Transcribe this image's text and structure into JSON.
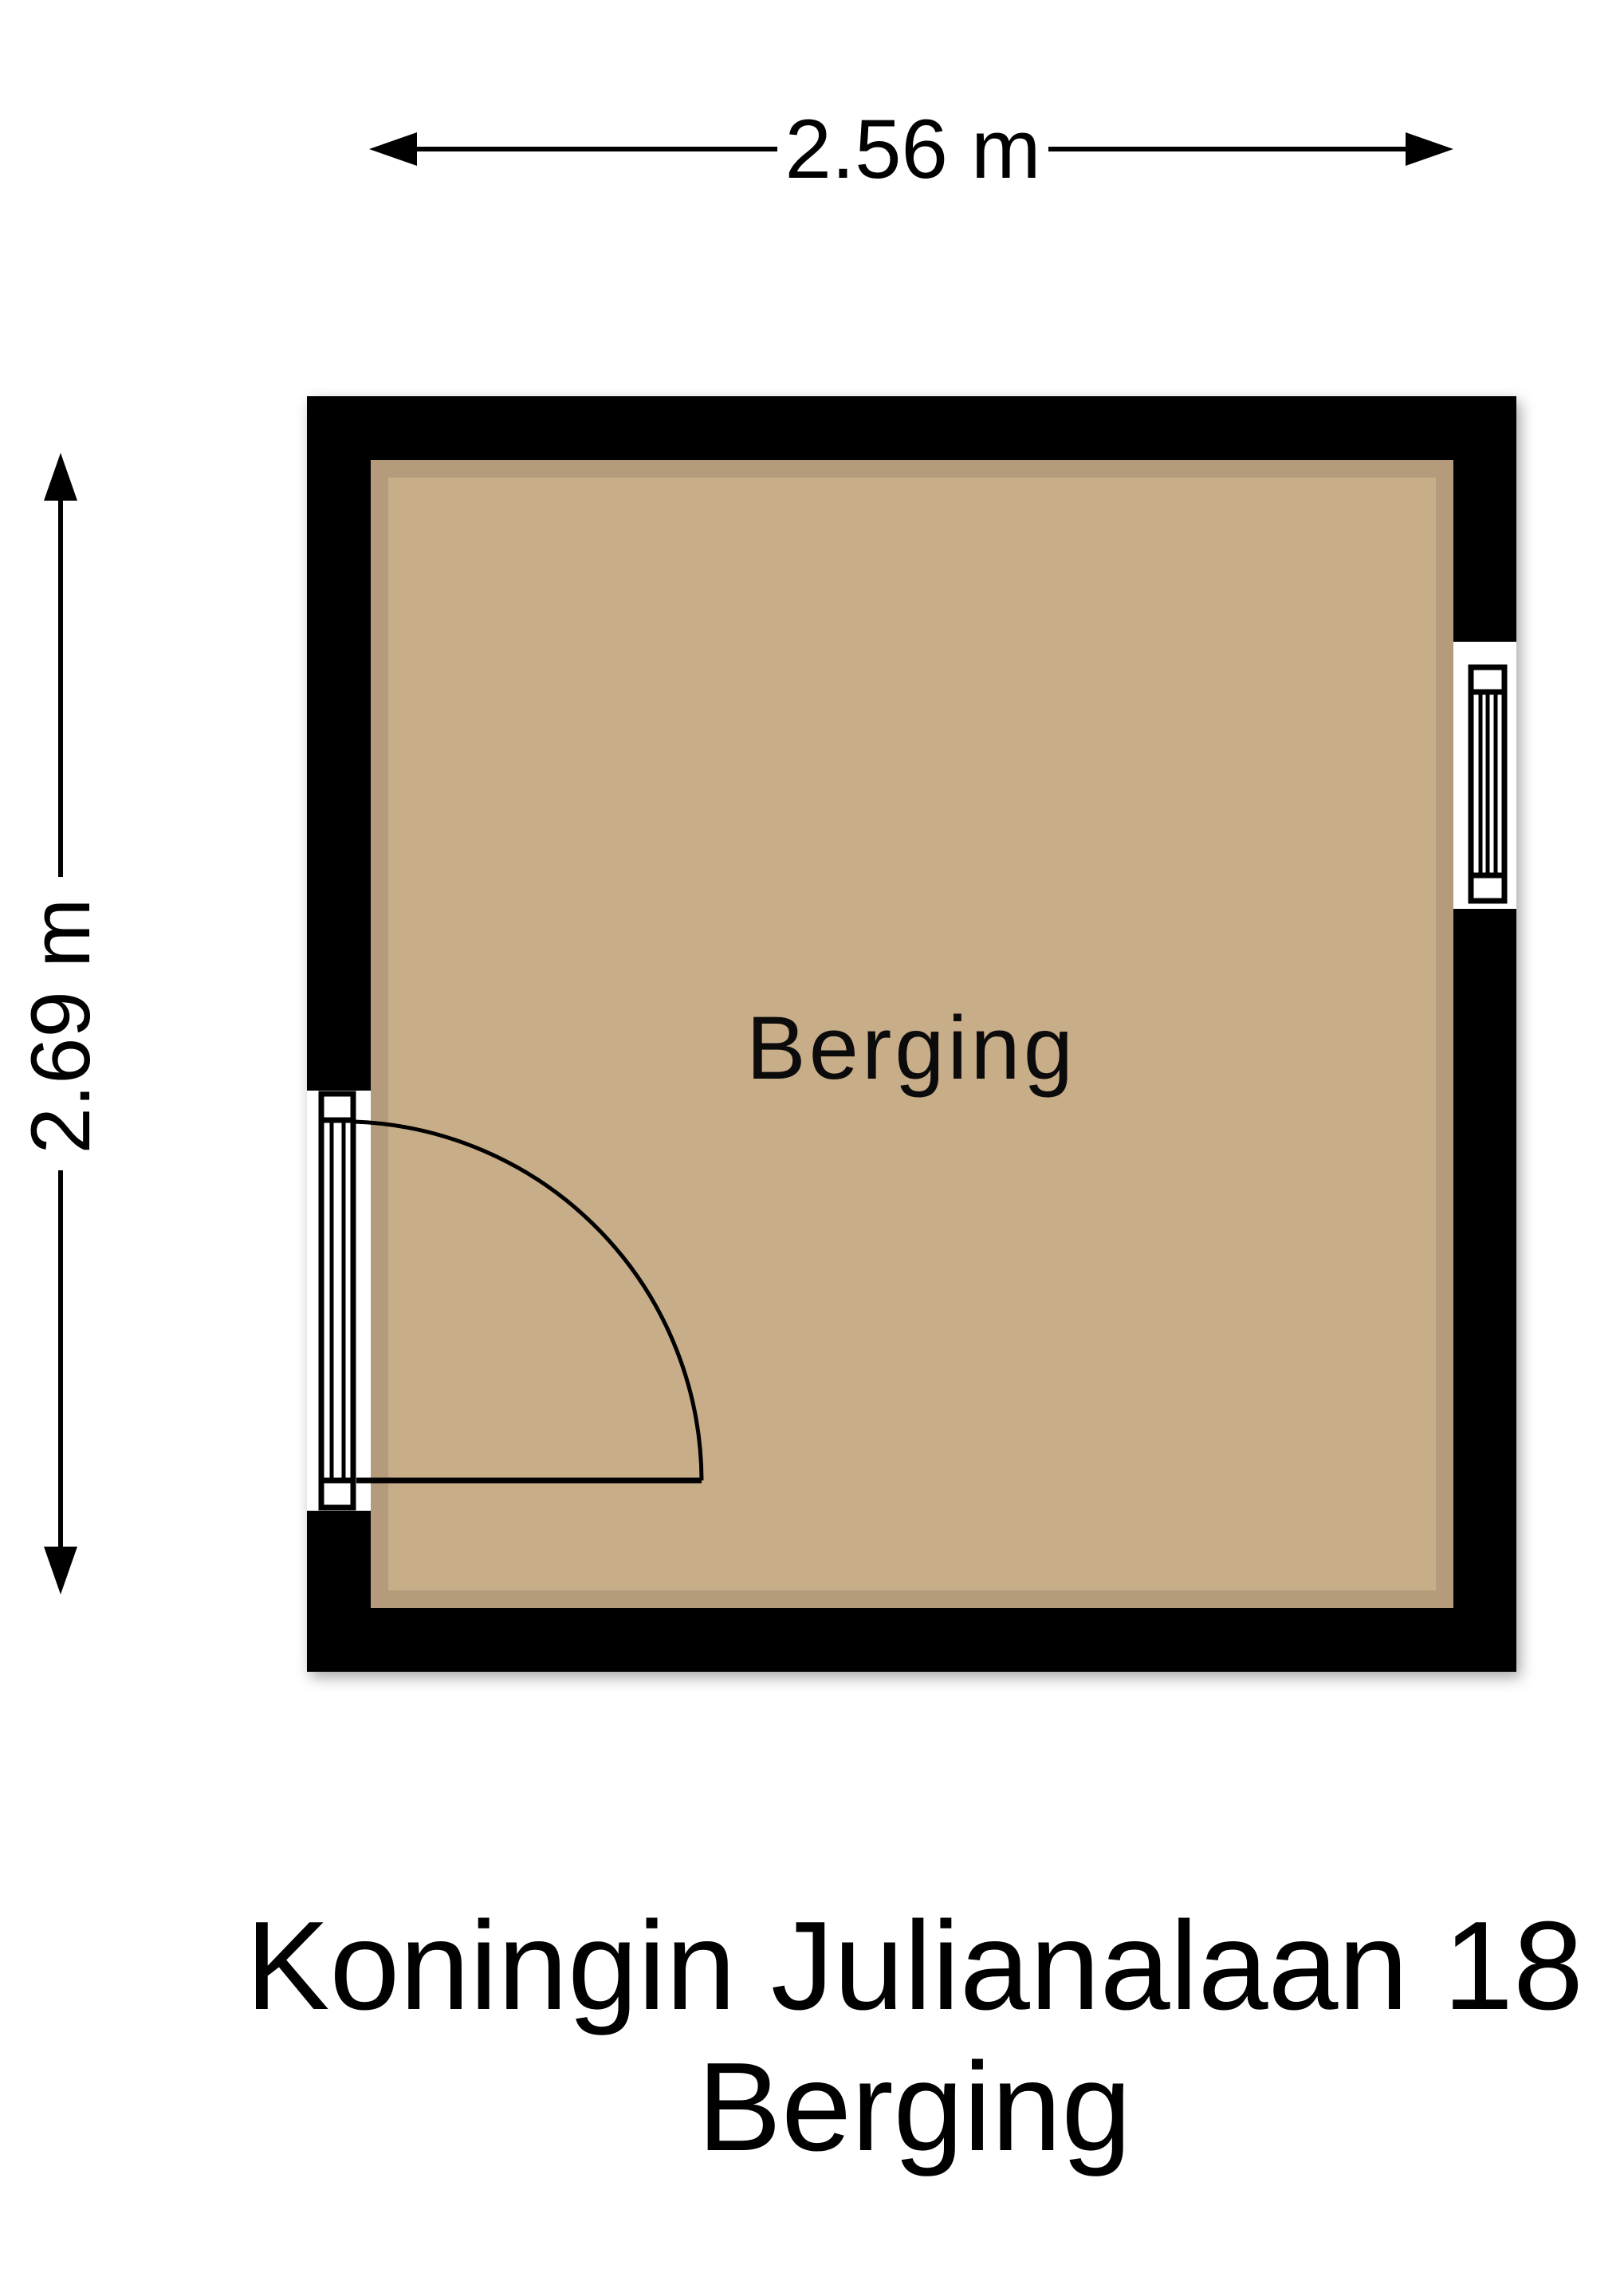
{
  "dimensions": {
    "width_label": "2.56 m",
    "height_label": "2.69 m"
  },
  "room": {
    "label": "Berging"
  },
  "title": {
    "line1": "Koningin Julianalaan 18",
    "line2": "Berging"
  },
  "colors": {
    "wall": "#000000",
    "floor": "#C8AD89",
    "background": "#FFFFFF",
    "line": "#000000"
  }
}
